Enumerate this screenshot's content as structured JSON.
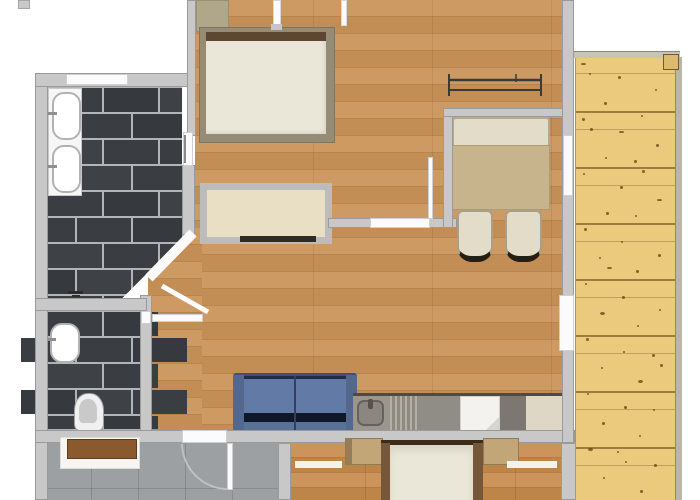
{
  "palette": {
    "wall": "#c8c8c8",
    "wallEdge": "#9a9a9a",
    "wood": "#cb9459",
    "wood2": "#c88c4d",
    "deck": "#ecca7d",
    "grout": "#b2b5b8",
    "tileA": "#3a3d42",
    "tileB": "#36393e",
    "tileC": "#3e4146",
    "entryFloor": "#9da0a2",
    "sofaBody": "#3f5078",
    "sofaCushion": "#617ba6",
    "sofaDarkCrease": "#0f1828",
    "mattress": "#eae6d8",
    "bedFrame": "#968c76",
    "headboard": "#5d4730",
    "tableTan": "#c7b48c",
    "seatBeige": "#e2dcc8",
    "wardrobeInterior": "#e8dfc4",
    "clothesRail": "#2f2b25",
    "benchWood": "#8a5a2e",
    "counterGray": "#908d86",
    "counterDark": "#7c7770",
    "counterBeige": "#ded7c5",
    "applianceWhite": "#f3f2ef",
    "bed2Rail": "#77573a",
    "nightstandTan": "#c3a678",
    "windowWhite": "#fbfbfb"
  },
  "floorplan": {
    "rooms": [
      {
        "id": "bathroom",
        "floor": "dark-subway-tile"
      },
      {
        "id": "wc",
        "floor": "dark-subway-tile"
      },
      {
        "id": "bedroom",
        "floor": "oak-plank"
      },
      {
        "id": "living-dining-kitchen",
        "floor": "oak-plank"
      },
      {
        "id": "hallway",
        "floor": "oak-plank"
      },
      {
        "id": "entry",
        "floor": "gray-tile"
      },
      {
        "id": "bedroom-2",
        "floor": "wood-plank"
      },
      {
        "id": "terrace",
        "floor": "pine-deck-planks"
      }
    ],
    "furniture": [
      "double-bed",
      "nightstand",
      "wardrobe-with-clothes-rail",
      "wall-radiator",
      "dining-bench",
      "dining-table",
      "dining-chair",
      "dining-chair",
      "two-seat-sofa",
      "kitchen-sink-counter",
      "kitchen-drainer",
      "kitchen-appliance",
      "bed",
      "nightstand",
      "nightstand",
      "entry-bench",
      "rug",
      "rug"
    ],
    "fixtures": [
      "vanity-basin",
      "vanity-basin",
      "floor-drain",
      "wash-basin",
      "toilet",
      "window",
      "window",
      "window",
      "door",
      "door",
      "door",
      "door-swing-arc"
    ]
  }
}
